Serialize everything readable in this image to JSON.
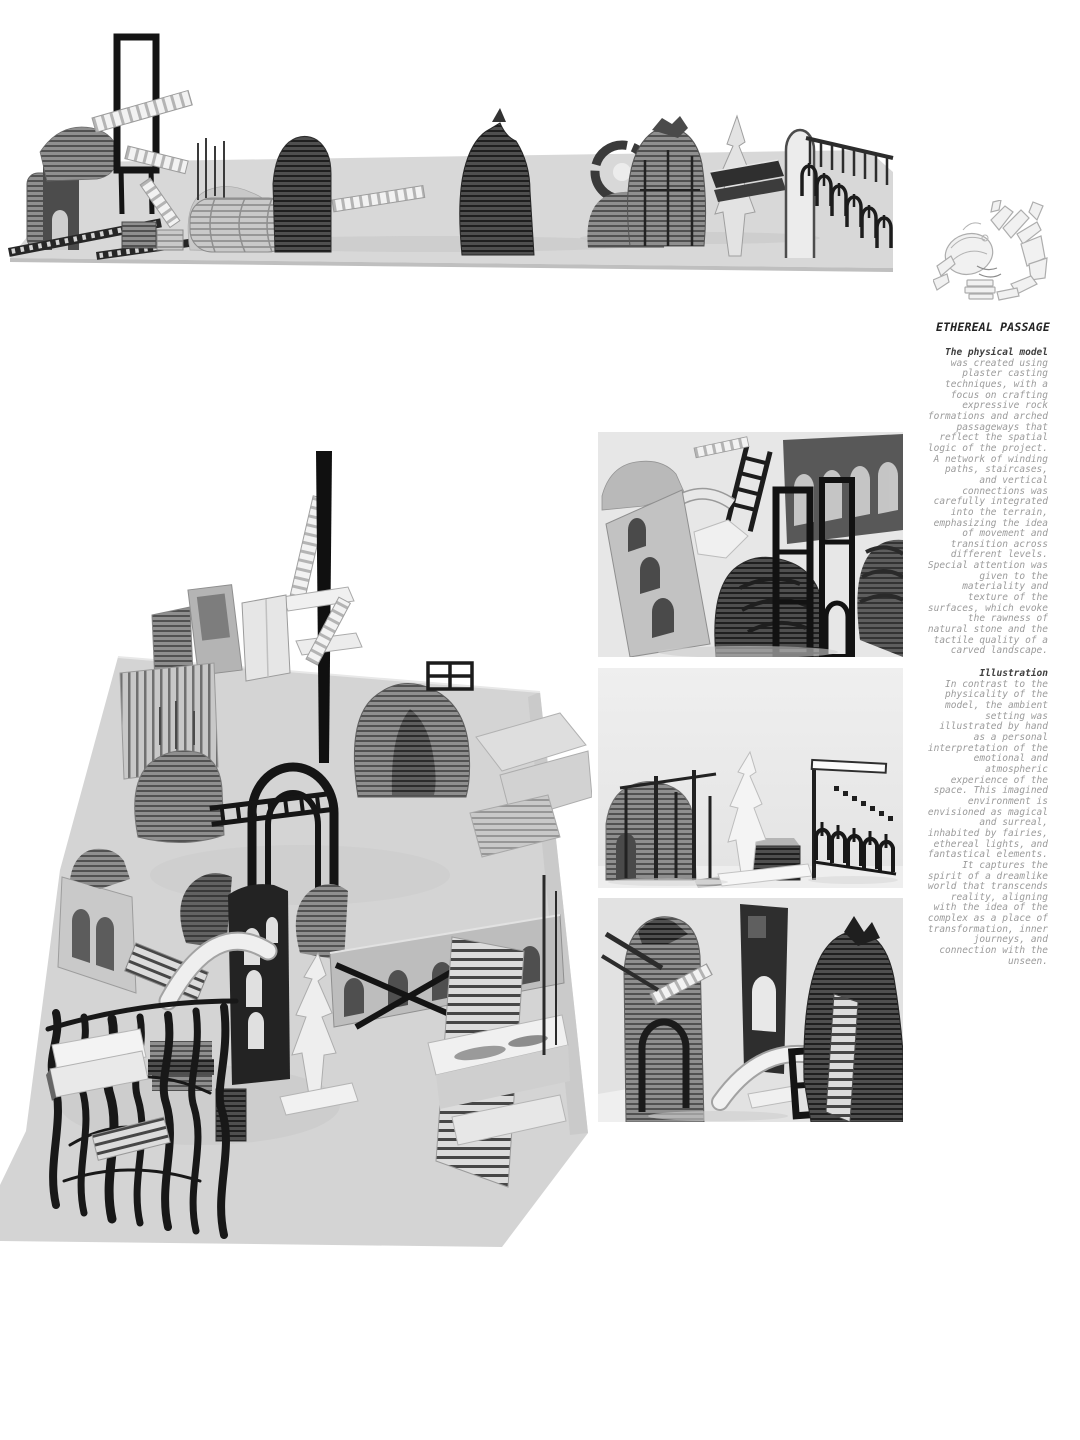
{
  "article": {
    "title": "ETHEREAL PASSAGE",
    "sections": [
      {
        "heading": "The physical model",
        "body": "was created using plaster casting techniques, with a focus on crafting expressive rock formations and arched passageways that reflect the spatial logic of the project. A network of winding paths, staircases, and vertical connections was carefully integrated into the terrain, emphasizing the idea of movement and transition across different levels. Special attention was given to the materiality and texture of the surfaces, which evoke the rawness of natural stone and the tactile quality of a carved landscape."
      },
      {
        "heading": "Illustration",
        "body": "In contrast to the physicality of the model, the ambient setting was illustrated by hand as a personal interpretation of the emotional and atmospheric experience of the space. This imagined environment is envisioned as magical and surreal, inhabited by fairies, ethereal lights, and fantastical elements. It captures the spirit of a dreamlike world that transcends reality, aligning with the idea of the complex as a place of transformation, inner journeys, and connection with the unseen."
      }
    ]
  },
  "colors": {
    "page_bg": "#ffffff",
    "title_text": "#242424",
    "heading_text": "#3f3f3f",
    "body_text": "#9b9b9b",
    "photo_bg": "#e6e6e6",
    "platform_gray": "#d5d5d5",
    "model_ink": "#161616"
  }
}
